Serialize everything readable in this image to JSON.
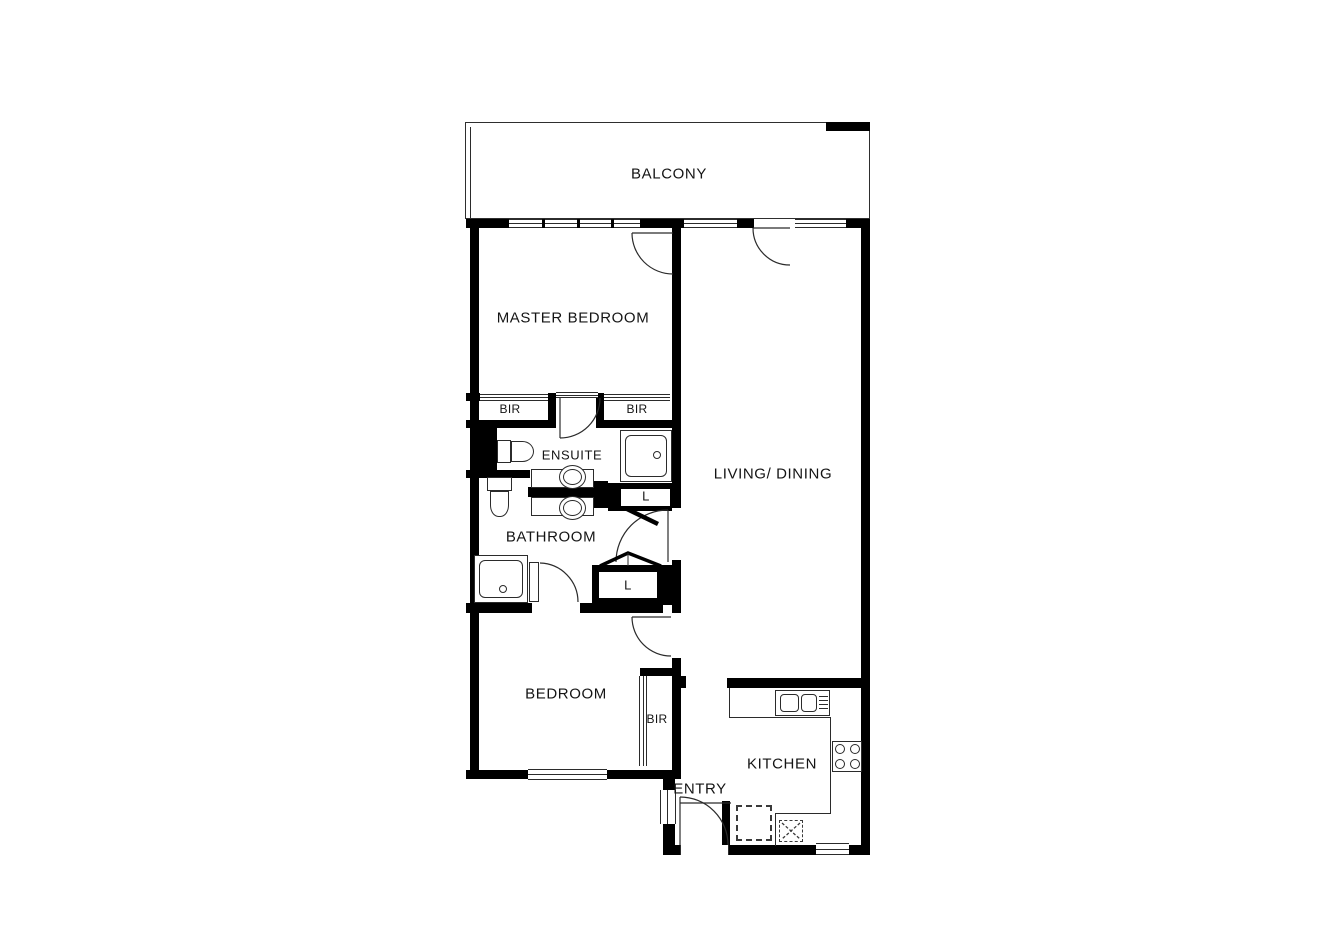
{
  "page": {
    "type": "apartment-floor-plan"
  },
  "colors": {
    "wall": "#000000",
    "line": "#2b2b2b",
    "background": "#ffffff",
    "text": "#141414"
  },
  "rooms": {
    "balcony": {
      "label": "BALCONY"
    },
    "master_bedroom": {
      "label": "MASTER BEDROOM"
    },
    "living_dining": {
      "label": "LIVING/ DINING"
    },
    "ensuite": {
      "label": "ENSUITE"
    },
    "bathroom": {
      "label": "BATHROOM"
    },
    "bedroom": {
      "label": "BEDROOM"
    },
    "kitchen": {
      "label": "KITCHEN"
    },
    "entry": {
      "label": "ENTRY"
    },
    "bir_master_left": {
      "label": "BIR"
    },
    "bir_master_right": {
      "label": "BIR"
    },
    "bir_bedroom": {
      "label": "BIR"
    },
    "linen_upper": {
      "label": "L"
    },
    "linen_lower": {
      "label": "L"
    }
  },
  "fixtures": [
    "ensuite-toilet",
    "ensuite-shower",
    "double-vanity-basins",
    "bathroom-toilet",
    "bathroom-shower",
    "kitchen-double-sink",
    "cooktop-4-burner",
    "fridge-space",
    "appliance-space"
  ]
}
